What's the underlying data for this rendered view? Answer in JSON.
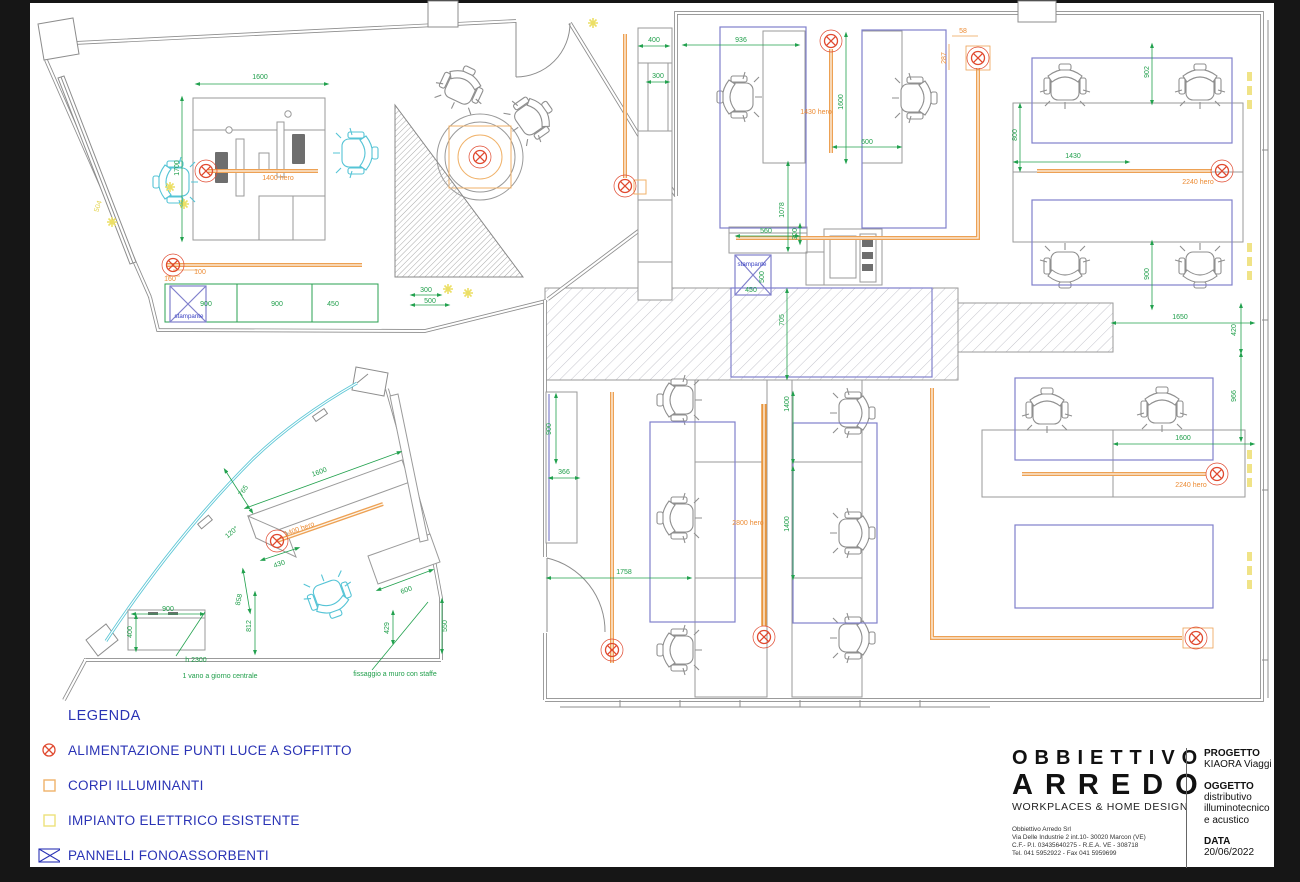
{
  "legend": {
    "title": "LEGENDA",
    "items": [
      {
        "icon": "power-symbol",
        "label": "ALIMENTAZIONE PUNTI LUCE A SOFFITTO"
      },
      {
        "icon": "orange-square",
        "label": "CORPI ILLUMINANTI"
      },
      {
        "icon": "yellow-square",
        "label": "IMPIANTO ELETTRICO ESISTENTE"
      },
      {
        "icon": "acoustic-panel",
        "label": "PANNELLI FONOASSORBENTI"
      }
    ]
  },
  "title_block": {
    "company_line1": "OBBIETTIVO",
    "company_line2": "ARREDO",
    "tagline": "WORKPLACES & HOME DESIGN",
    "address_lines": [
      "Obbiettivo Arredo Srl",
      "Via Delle Industrie 2 int.10- 30020 Marcon (VE)",
      "C.F.- P.I. 03435640275  - R.E.A. VE - 308718",
      "Tel. 041 5952922 - Fax 041 5959699"
    ],
    "progetto_label": "PROGETTO",
    "progetto_value": "KIAORA Viaggi",
    "oggetto_label": "OGGETTO",
    "oggetto_lines": [
      "distributivo",
      "illuminotecnico",
      "e acustico"
    ],
    "data_label": "DATA",
    "data_value": "20/06/2022"
  },
  "colors": {
    "dimension_green": "#22a14e",
    "cable_orange": "#eda154",
    "power_red": "#e0492f",
    "panel_blue": "#8080cc",
    "existing_yellow": "#ece27a",
    "wall_gray": "#8d8d8d",
    "chair_cyan": "#55c4d6",
    "legend_blue": "#2a33b5"
  },
  "plan_labels": [
    {
      "t": "1600",
      "x": 260,
      "y": 79,
      "c": "g"
    },
    {
      "t": "1700",
      "x": 179,
      "y": 168,
      "c": "g",
      "r": -90
    },
    {
      "t": "1400 hero",
      "x": 278,
      "y": 180,
      "c": "o"
    },
    {
      "t": "504",
      "x": 100,
      "y": 207,
      "c": "y",
      "r": -72
    },
    {
      "t": "100",
      "x": 200,
      "y": 274,
      "c": "o"
    },
    {
      "t": "160",
      "x": 170,
      "y": 281,
      "c": "o"
    },
    {
      "t": "900",
      "x": 206,
      "y": 306,
      "c": "g"
    },
    {
      "t": "900",
      "x": 277,
      "y": 306,
      "c": "g"
    },
    {
      "t": "450",
      "x": 333,
      "y": 306,
      "c": "g"
    },
    {
      "t": "stampante",
      "x": 189,
      "y": 318,
      "c": "b"
    },
    {
      "t": "300",
      "x": 426,
      "y": 292,
      "c": "g"
    },
    {
      "t": "500",
      "x": 430,
      "y": 303,
      "c": "g"
    },
    {
      "t": "400",
      "x": 654,
      "y": 42,
      "c": "g"
    },
    {
      "t": "300",
      "x": 658,
      "y": 78,
      "c": "g"
    },
    {
      "t": "936",
      "x": 741,
      "y": 42,
      "c": "g"
    },
    {
      "t": "1600",
      "x": 843,
      "y": 102,
      "c": "g",
      "r": -90
    },
    {
      "t": "1430 hero",
      "x": 816,
      "y": 114,
      "c": "o"
    },
    {
      "t": "600",
      "x": 867,
      "y": 144,
      "c": "g"
    },
    {
      "t": "1078",
      "x": 784,
      "y": 210,
      "c": "g",
      "r": -90
    },
    {
      "t": "300",
      "x": 797,
      "y": 234,
      "c": "g",
      "r": -90
    },
    {
      "t": "560",
      "x": 766,
      "y": 233,
      "c": "g"
    },
    {
      "t": "stampante",
      "x": 752,
      "y": 266,
      "c": "b"
    },
    {
      "t": "450",
      "x": 751,
      "y": 292,
      "c": "g"
    },
    {
      "t": "500",
      "x": 764,
      "y": 277,
      "c": "g",
      "r": -90
    },
    {
      "t": "58",
      "x": 963,
      "y": 33,
      "c": "o"
    },
    {
      "t": "287",
      "x": 946,
      "y": 58,
      "c": "o",
      "r": -90
    },
    {
      "t": "705",
      "x": 784,
      "y": 320,
      "c": "g",
      "r": -90
    },
    {
      "t": "902",
      "x": 1149,
      "y": 72,
      "c": "g",
      "r": -90
    },
    {
      "t": "800",
      "x": 1017,
      "y": 135,
      "c": "g",
      "r": -90
    },
    {
      "t": "1430",
      "x": 1073,
      "y": 158,
      "c": "g"
    },
    {
      "t": "2240 hero",
      "x": 1198,
      "y": 184,
      "c": "o"
    },
    {
      "t": "900",
      "x": 1149,
      "y": 274,
      "c": "g",
      "r": -90
    },
    {
      "t": "1650",
      "x": 1180,
      "y": 319,
      "c": "g"
    },
    {
      "t": "420",
      "x": 1236,
      "y": 330,
      "c": "g",
      "r": -90
    },
    {
      "t": "966",
      "x": 1236,
      "y": 396,
      "c": "g",
      "r": -90
    },
    {
      "t": "1600",
      "x": 1183,
      "y": 440,
      "c": "g"
    },
    {
      "t": "2240 hero",
      "x": 1191,
      "y": 487,
      "c": "o"
    },
    {
      "t": "900",
      "x": 551,
      "y": 429,
      "c": "g",
      "r": -90
    },
    {
      "t": "366",
      "x": 564,
      "y": 474,
      "c": "g"
    },
    {
      "t": "1758",
      "x": 624,
      "y": 574,
      "c": "g"
    },
    {
      "t": "1400",
      "x": 789,
      "y": 404,
      "c": "g",
      "r": -90
    },
    {
      "t": "1400",
      "x": 789,
      "y": 524,
      "c": "g",
      "r": -90
    },
    {
      "t": "2800 hero",
      "x": 748,
      "y": 525,
      "c": "o"
    },
    {
      "t": "765",
      "x": 245,
      "y": 492,
      "c": "g",
      "r": -55
    },
    {
      "t": "120°",
      "x": 233,
      "y": 534,
      "c": "g",
      "r": -40
    },
    {
      "t": "1600",
      "x": 320,
      "y": 474,
      "c": "g",
      "r": -20
    },
    {
      "t": "430",
      "x": 280,
      "y": 566,
      "c": "g",
      "r": -20
    },
    {
      "t": "858",
      "x": 241,
      "y": 600,
      "c": "g",
      "r": -78
    },
    {
      "t": "812",
      "x": 251,
      "y": 626,
      "c": "g",
      "r": -90
    },
    {
      "t": "600",
      "x": 407,
      "y": 592,
      "c": "g",
      "r": -20
    },
    {
      "t": "429",
      "x": 389,
      "y": 628,
      "c": "g",
      "r": -90
    },
    {
      "t": "550",
      "x": 447,
      "y": 626,
      "c": "g",
      "r": -90
    },
    {
      "t": "900",
      "x": 168,
      "y": 611,
      "c": "g"
    },
    {
      "t": "400",
      "x": 132,
      "y": 632,
      "c": "g",
      "r": -90
    },
    {
      "t": "1400 hero",
      "x": 300,
      "y": 531,
      "c": "o",
      "r": -20
    },
    {
      "t": "h 2300",
      "x": 196,
      "y": 662,
      "c": "g",
      "n": "note-label"
    },
    {
      "t": "1 vano a giorno centrale",
      "x": 220,
      "y": 678,
      "c": "g",
      "n": "note-label"
    },
    {
      "t": "fissaggio a muro con staffe",
      "x": 395,
      "y": 676,
      "c": "g",
      "n": "note-label"
    }
  ]
}
